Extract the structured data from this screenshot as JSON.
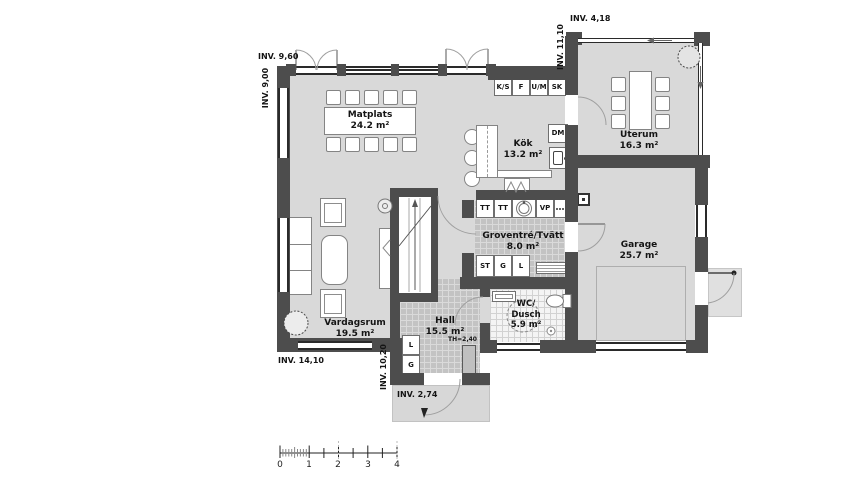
{
  "plan": {
    "colors": {
      "wall": "#4d4d4d",
      "floor": "#d9d9d9",
      "tile": "#c3c3c3",
      "arc": "#a0a0a0"
    },
    "rooms": {
      "matplats": {
        "name": "Matplats",
        "area": "24.2 m²"
      },
      "kok": {
        "name": "Kök",
        "area": "13.2 m²"
      },
      "uterum": {
        "name": "Uterum",
        "area": "16.3 m²"
      },
      "garage": {
        "name": "Garage",
        "area": "25.7 m²"
      },
      "vardagsrum": {
        "name": "Vardagsrum",
        "area": "19.5 m²"
      },
      "hall": {
        "name": "Hall",
        "area": "15.5 m²"
      },
      "wc": {
        "line1": "WC/",
        "line2": "Dusch",
        "area": "5.9 m²"
      },
      "groventre": {
        "name": "Groventré/Tvätt",
        "area": "8.0 m²"
      }
    },
    "dims": {
      "top_left": "INV. 9,60",
      "left": "INV. 9,00",
      "uterum_top": "INV. 4,18",
      "right_col": "INV. 11,10",
      "bottom_left": "INV. 14,10",
      "entry_side": "INV. 10,20",
      "entry_width": "INV. 2,74",
      "door_height": "TH=2,40"
    },
    "labels": {
      "kitchen_row": [
        "K/S",
        "F",
        "U/M",
        "SK"
      ],
      "dishwasher": "DM",
      "laundry_row": [
        "TT",
        "TT",
        "VP"
      ],
      "storage_row": [
        "ST",
        "G",
        "L"
      ],
      "hall_cabinets": [
        "L",
        "G"
      ]
    },
    "scale": {
      "ticks": [
        "0",
        "1",
        "2",
        "3",
        "4"
      ]
    }
  }
}
